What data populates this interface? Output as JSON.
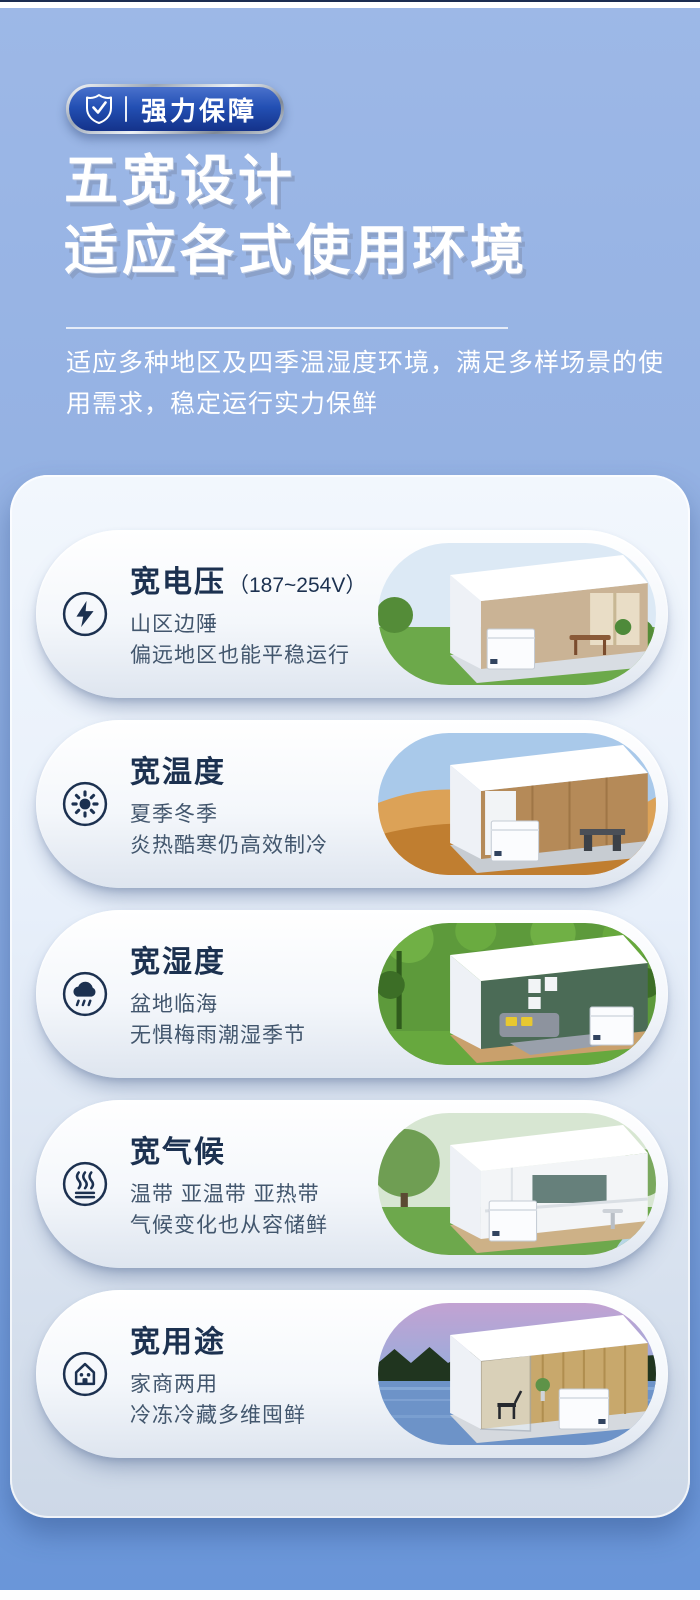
{
  "theme": {
    "bg_top": "#9db8e7",
    "bg_bottom": "#6a96d9",
    "badge_blue_top": "#4a71cc",
    "badge_blue_bottom": "#14328a",
    "navy_text": "#1c3150",
    "body_text": "#42566d",
    "panel_top": "#f2f7fd",
    "panel_bottom": "#cdd8e7",
    "card_bg": "#ffffff"
  },
  "header": {
    "badge": {
      "icon": "shield-check-icon",
      "label": "强力保障"
    },
    "title_line1": "五宽设计",
    "title_line2": "适应各式使用环境",
    "subtitle_line1": "适应多种地区及四季温湿度环境，满足多样场景的使",
    "subtitle_line2": "用需求，稳定运行实力保鲜"
  },
  "cards": [
    {
      "icon": "lightning-icon",
      "title": "宽电压",
      "title_suffix": "（187~254V）",
      "line1": "山区边陲",
      "line2": "偏远地区也能平稳运行",
      "scene": "grass-living-room-with-chest-freezer"
    },
    {
      "icon": "sun-icon",
      "title": "宽温度",
      "title_suffix": "",
      "line1": "夏季冬季",
      "line2": "炎热酷寒仍高效制冷",
      "scene": "desert-kitchen-with-chest-freezer"
    },
    {
      "icon": "rain-cloud-icon",
      "title": "宽湿度",
      "title_suffix": "",
      "line1": "盆地临海",
      "line2": "无惧梅雨潮湿季节",
      "scene": "rainforest-living-room-with-chest-freezer"
    },
    {
      "icon": "heat-waves-icon",
      "title": "宽气候",
      "title_suffix": "",
      "line1": "温带 亚温带 亚热带",
      "line2": "气候变化也从容储鲜",
      "scene": "garden-kitchen-with-chest-freezer"
    },
    {
      "icon": "house-icon",
      "title": "宽用途",
      "title_suffix": "",
      "line1": "家商两用",
      "line2": "冷冻冷藏多维囤鲜",
      "scene": "lakeside-room-with-chest-freezer"
    }
  ]
}
